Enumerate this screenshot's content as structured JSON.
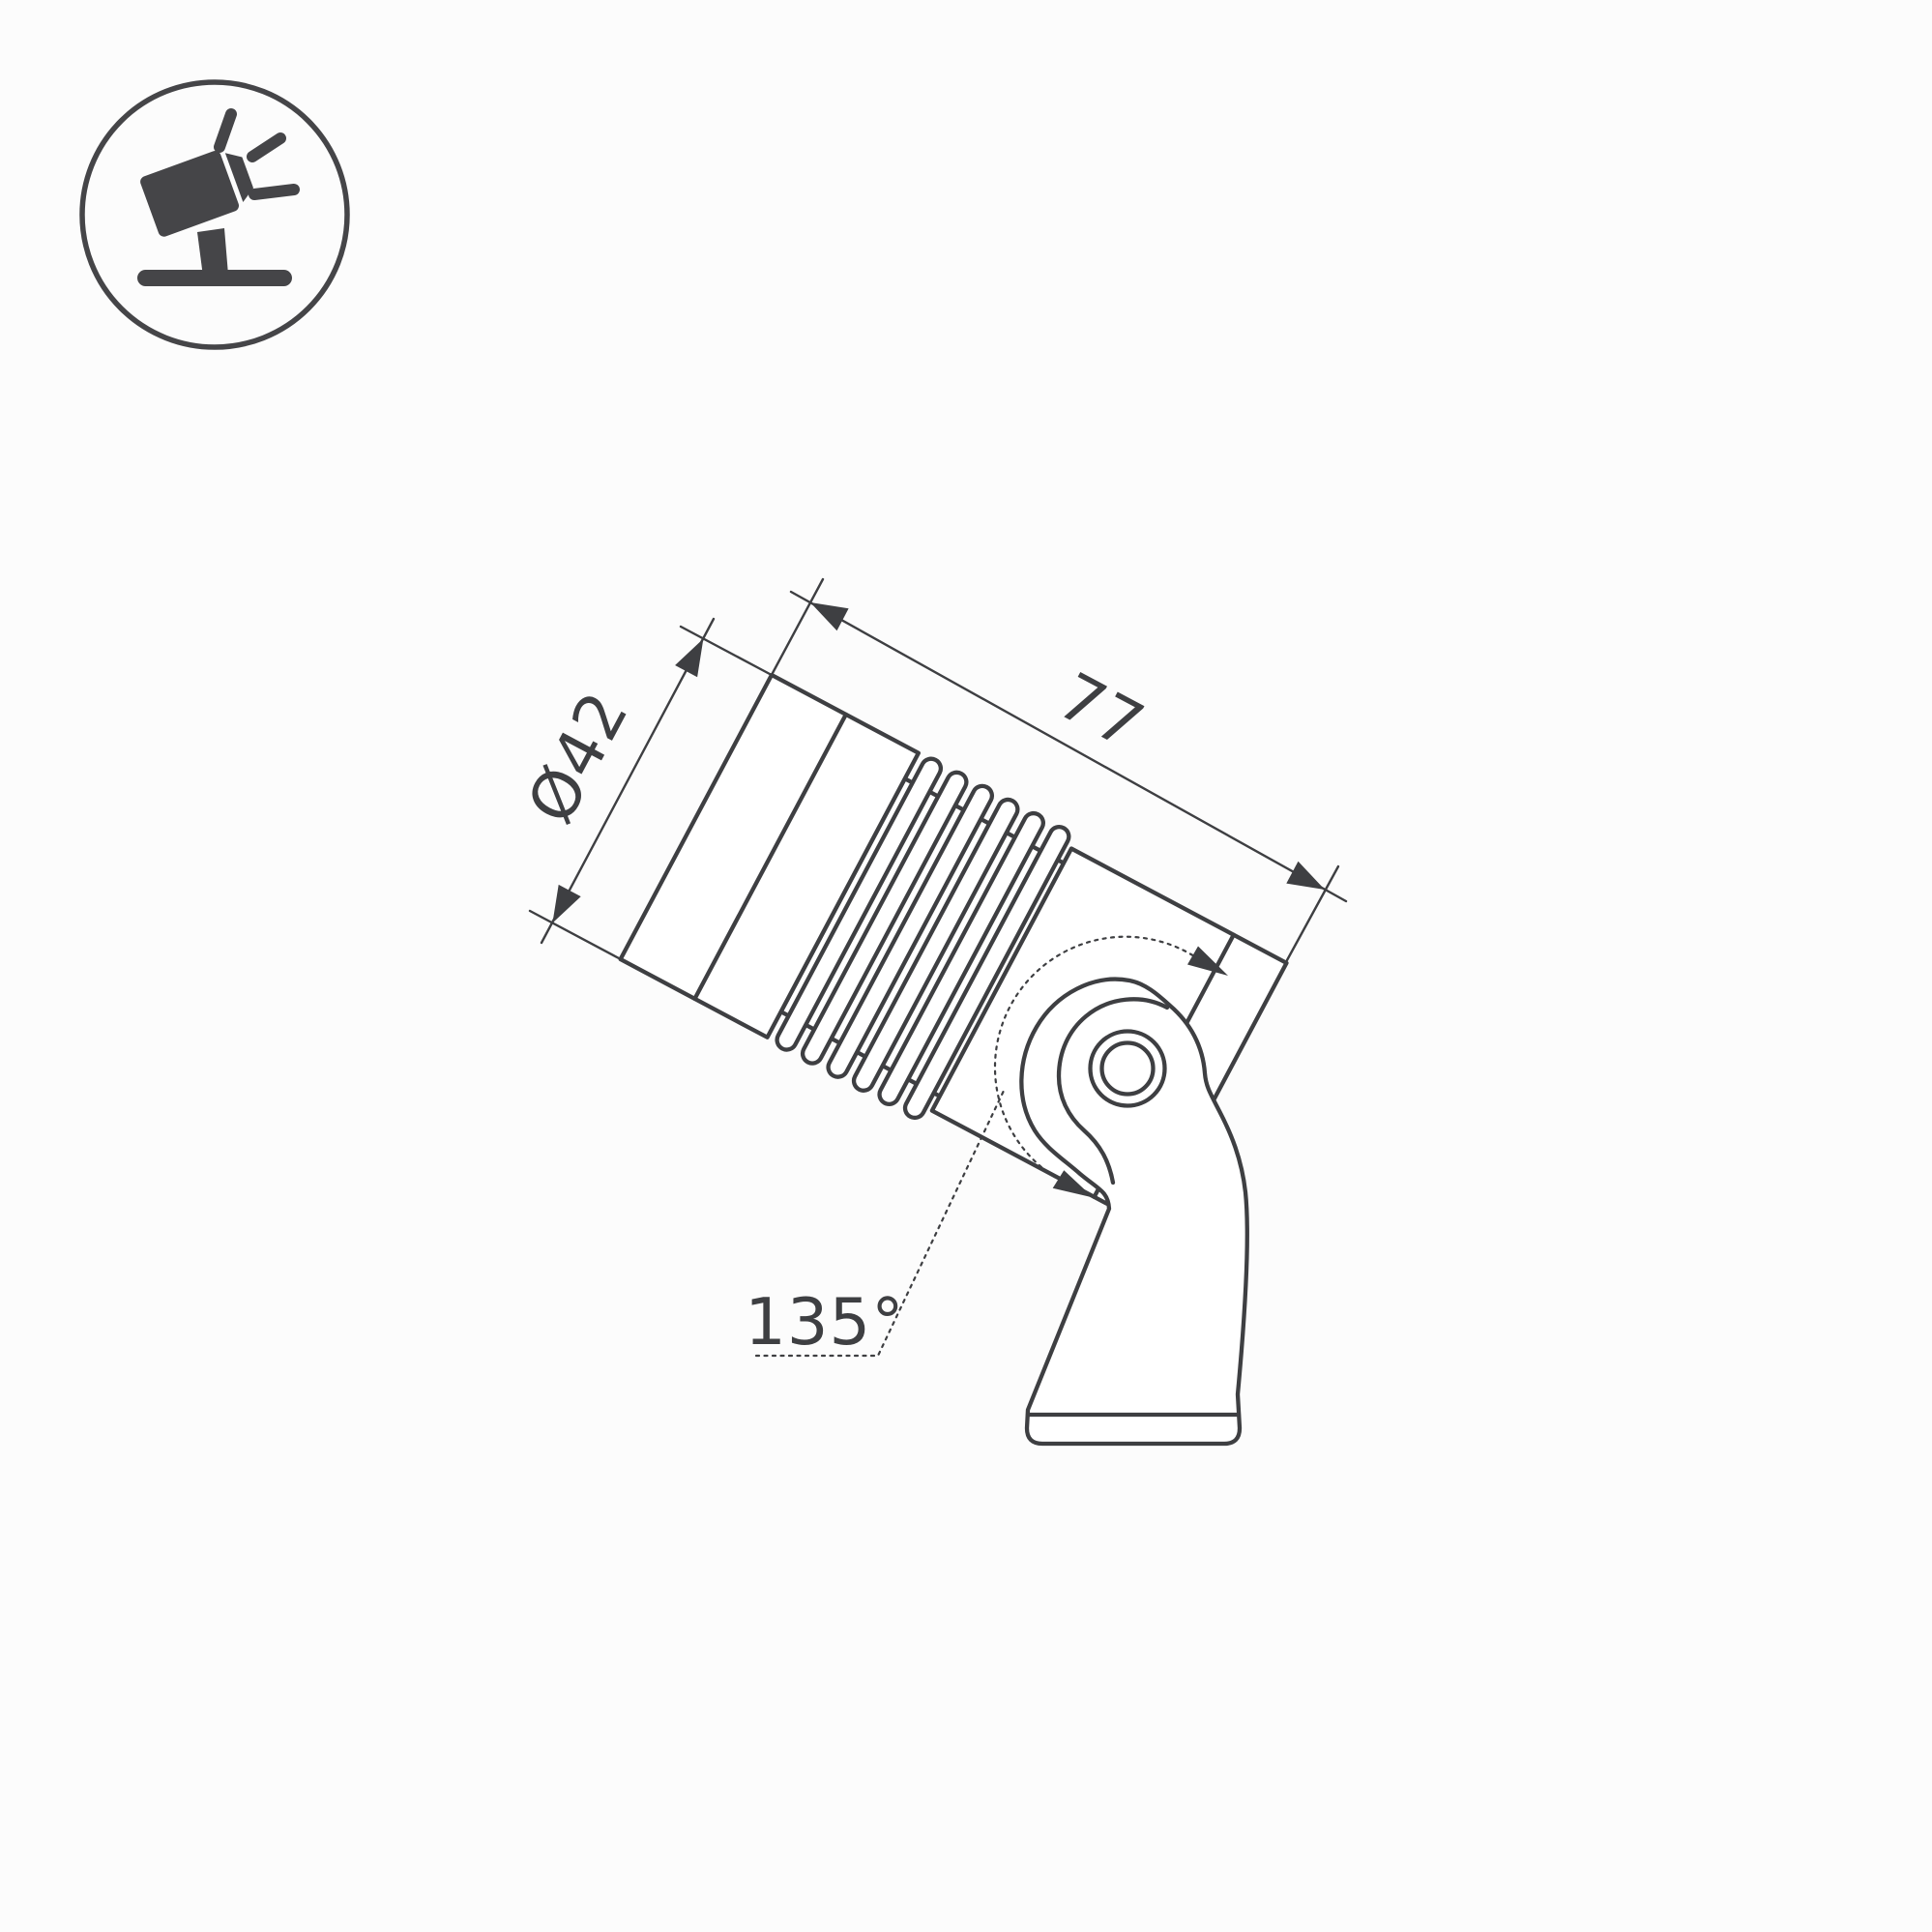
{
  "page": {
    "background": "#fcfcfc",
    "type": "technical-dimension-drawing"
  },
  "icon_badge": {
    "name": "tilted-spotlight-on-stand",
    "color": "#454548"
  },
  "drawing": {
    "subject": "ground-mount LED spotlight, side view with swivel bracket",
    "line_color": "#3e3f42",
    "tilt_angle_deg": 28,
    "dimensions": {
      "diameter": {
        "label": "Ø42",
        "value": 42,
        "unit": "mm"
      },
      "length": {
        "label": "77",
        "value": 77,
        "unit": "mm"
      },
      "swivel": {
        "label": "135°",
        "value": 135,
        "unit": "deg"
      }
    }
  }
}
